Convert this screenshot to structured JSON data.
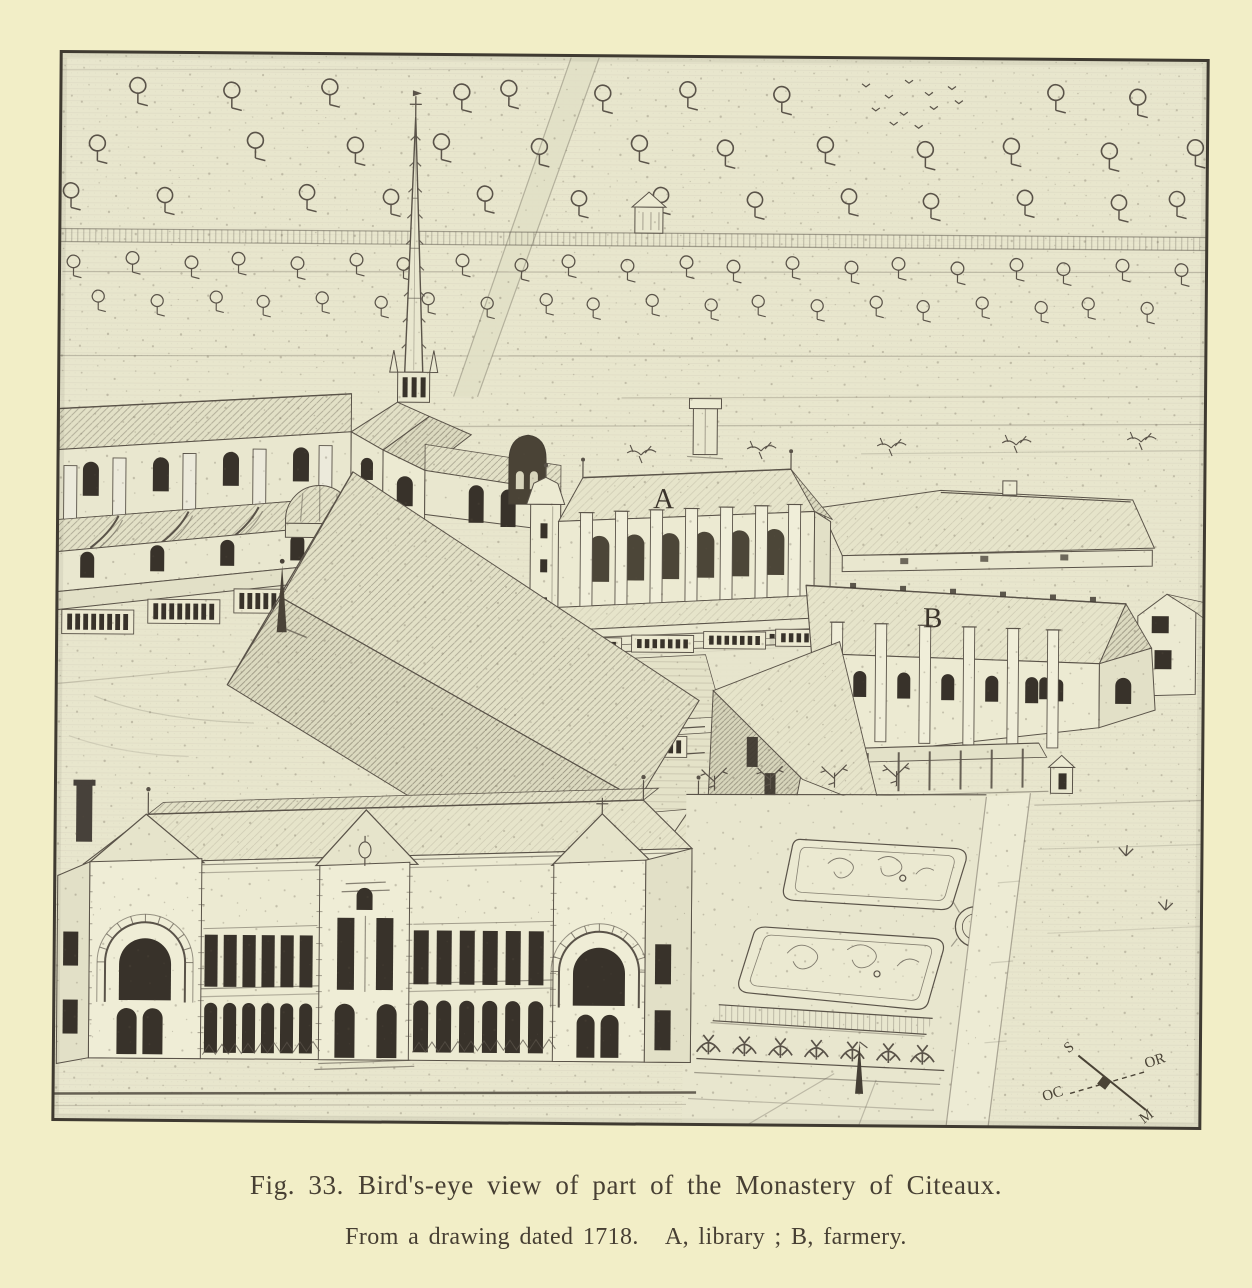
{
  "figure": {
    "number": "Fig. 33.",
    "caption_title": "Bird's-eye view of part of the Monastery of Citeaux.",
    "caption_sub_left": "From a drawing dated 1718.",
    "caption_sub_right": "A, library ; B, farmery.",
    "labels": {
      "library": "A",
      "farmery": "B"
    },
    "compass": {
      "north": "S",
      "east": "OR",
      "west": "OC",
      "south": "M"
    },
    "colors": {
      "paper": "#f2eec7",
      "plate_ground": "#e8e6cd",
      "ink": "#5a5349",
      "ink_dark": "#453f35",
      "window_dark": "#38322a"
    }
  }
}
